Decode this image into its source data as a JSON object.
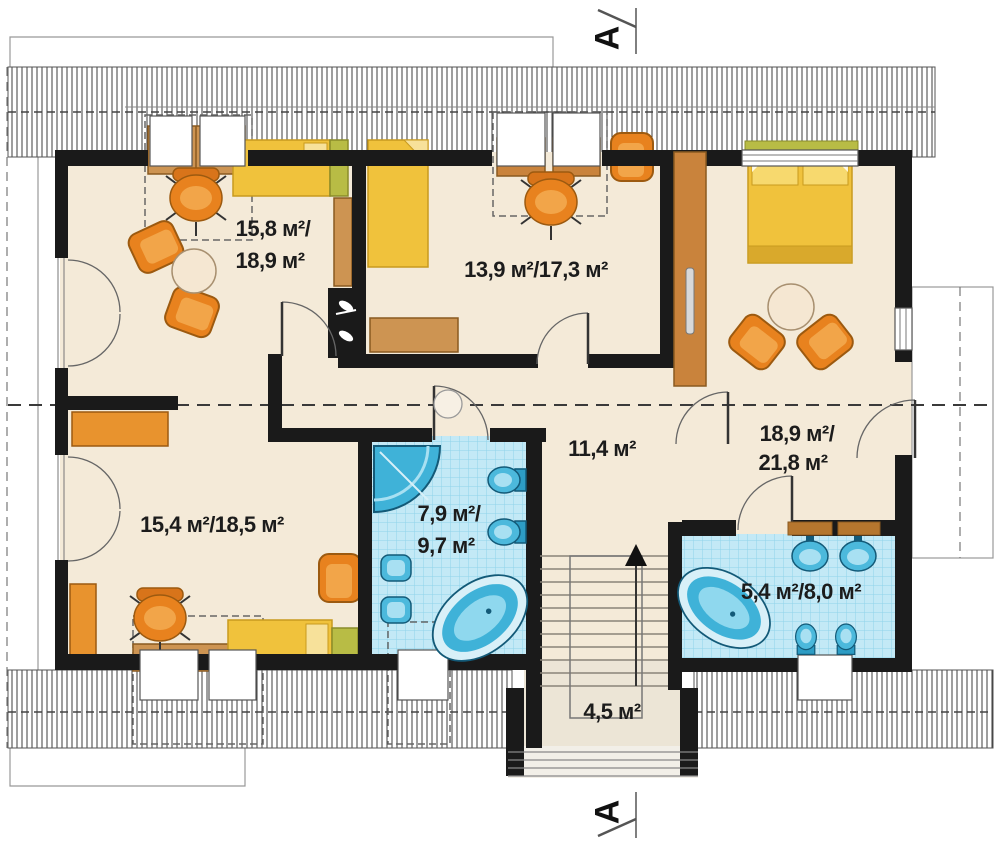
{
  "plan": {
    "title": "attic-floor-plan",
    "section_marker": "A",
    "rooms": [
      {
        "id": "bedroom-top-left",
        "line1": "15,8 м²/",
        "line2": "18,9 м²"
      },
      {
        "id": "bedroom-top-middle",
        "line1": "13,9 м²/17,3 м²"
      },
      {
        "id": "bedroom-top-right",
        "line1": "18,9 м²/",
        "line2": "21,8 м²"
      },
      {
        "id": "bedroom-bottom-left",
        "line1": "15,4 м²/18,5 м²"
      },
      {
        "id": "bathroom-main",
        "line1": "7,9 м²/",
        "line2": "9,7 м²"
      },
      {
        "id": "hall",
        "line1": "11,4 м²"
      },
      {
        "id": "bathroom-small",
        "line1": "5,4 м²/8,0 м²"
      },
      {
        "id": "staircase",
        "line1": "4,5 м²"
      }
    ],
    "colors": {
      "wall": "#1a1a1a",
      "floor": "#f4ead8",
      "tile_floor": "#c3e9f6",
      "fixture_blue": "#4cb9dc",
      "furniture_orange": "#e8821e",
      "furniture_tan": "#cd9452",
      "bed_yellow": "#f0c23c",
      "bed_green": "#b8bc45"
    }
  }
}
